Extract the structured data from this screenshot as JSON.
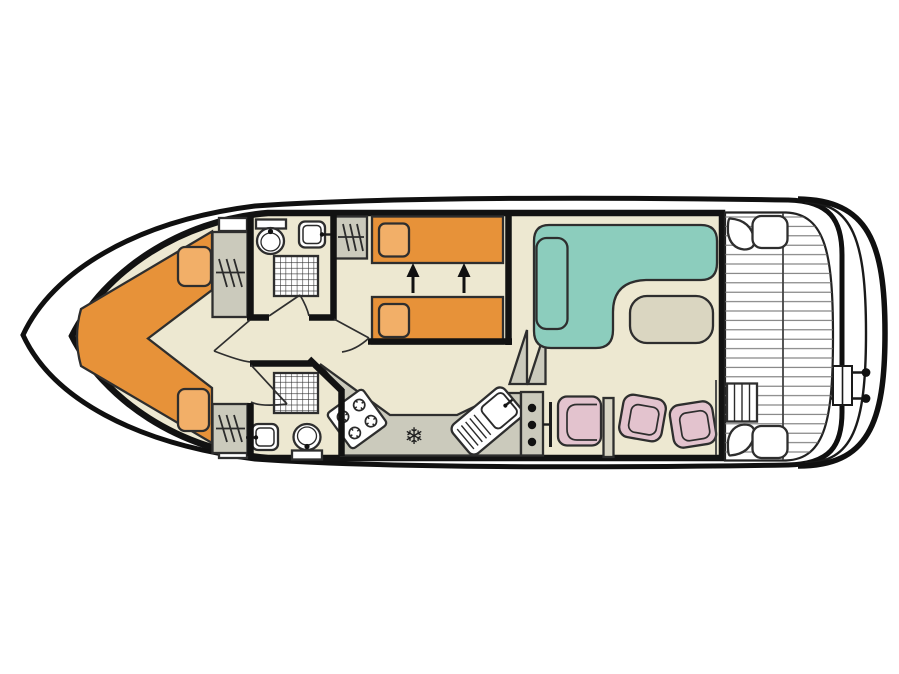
{
  "diagram": {
    "type": "boat-floor-plan",
    "view": "top-down deck plan of a canal cruiser"
  },
  "colors": {
    "background": "#ffffff",
    "floor_beige": "#EDE8D1",
    "bed_orange": "#E79239",
    "pillow_orange": "#F2AF68",
    "sofa_teal": "#8CCDBD",
    "chair_pink": "#E3C3CE",
    "cabinet_gray": "#CBCABC",
    "stub_gray": "#D8D5C4",
    "table_beige": "#DAD6C1",
    "outline_dark": "#1c1c1c"
  },
  "icons": {
    "freezer_glyph": "❄"
  }
}
